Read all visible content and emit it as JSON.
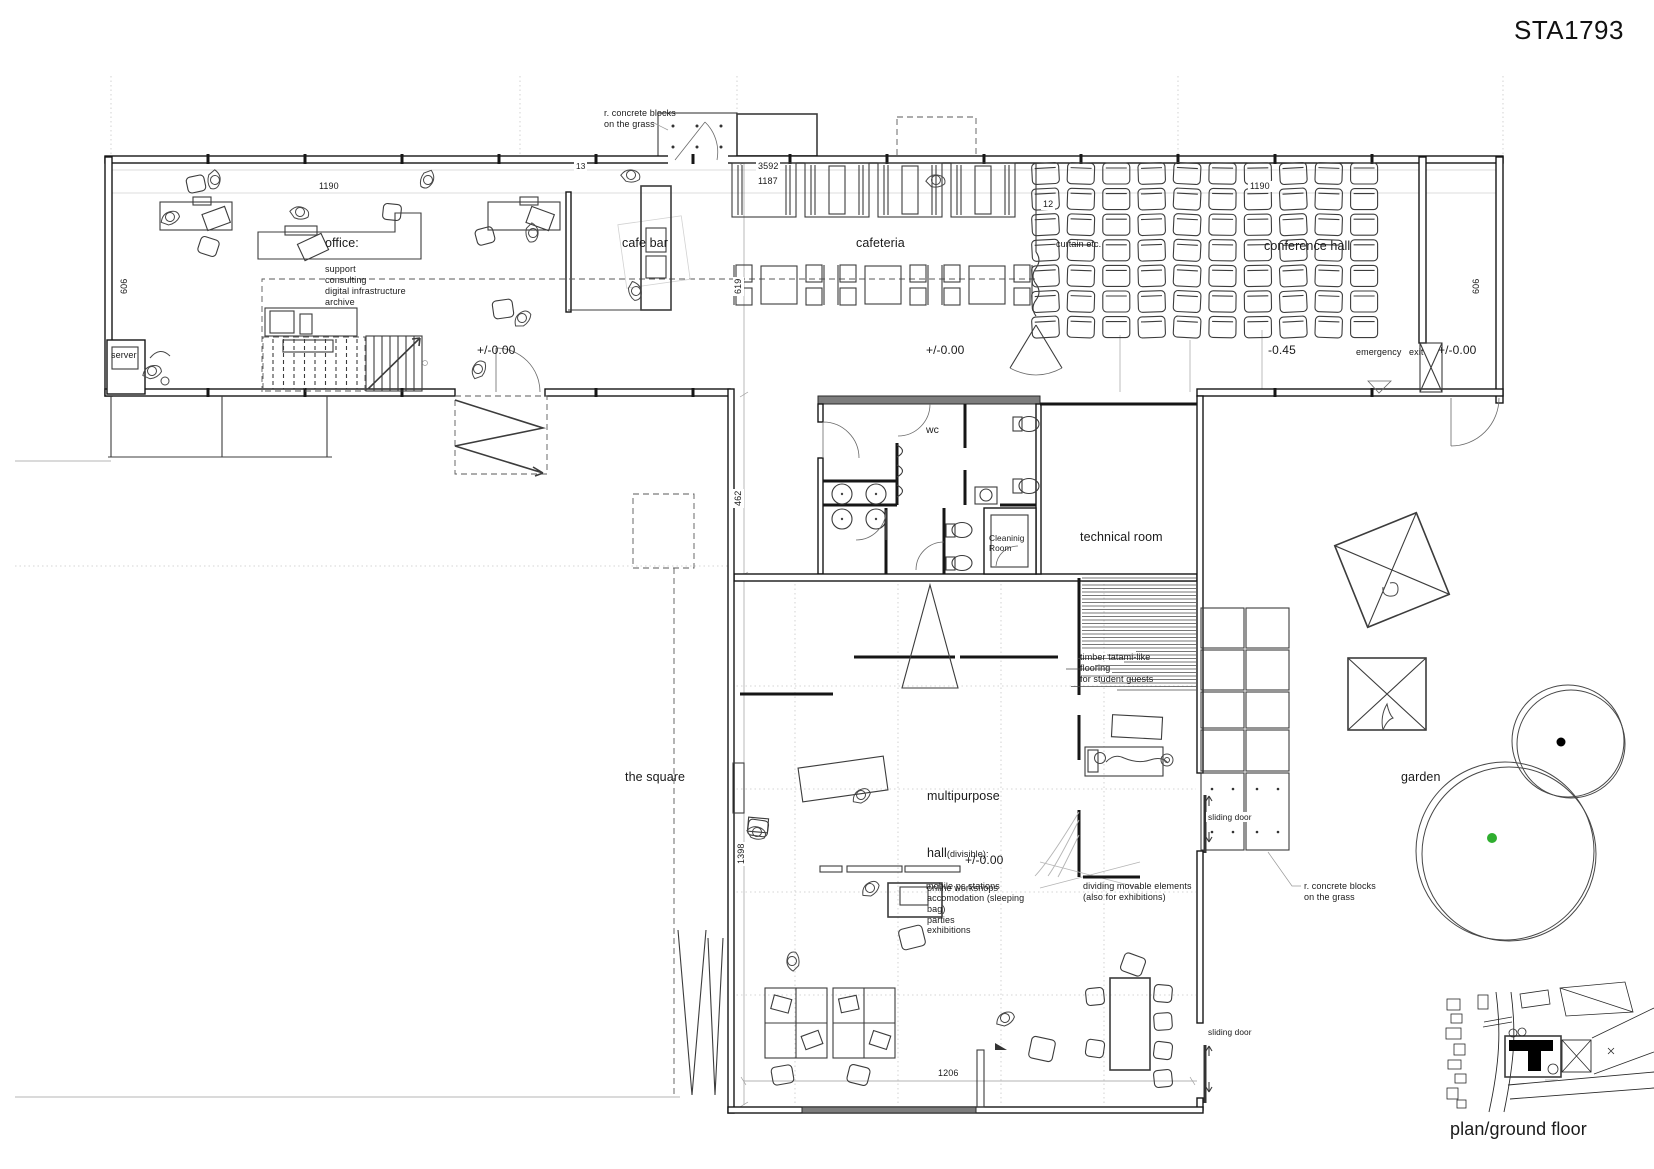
{
  "title": "STA1793",
  "caption": "plan/ground floor",
  "rooms": {
    "office": {
      "name": "office:",
      "functions": "support\nconsulting\ndigital infrastructure\narchive",
      "server": "server",
      "level": "+/-0.00"
    },
    "cafe_bar": {
      "name": "cafe bar"
    },
    "cafeteria": {
      "name": "cafeteria",
      "level": "+/-0.00"
    },
    "conference_hall": {
      "name": "conference hall",
      "level": "-0.45",
      "curtain": "curtain etc.",
      "emergency_exit": "emergency exit",
      "exit_level": "+/-0.00"
    },
    "wc": {
      "name": "wc",
      "cleaning_room": "Cleaninig\nRoom"
    },
    "technical_room": {
      "name": "technical room"
    },
    "multipurpose_hall": {
      "name_line1": "multipurpose",
      "name_line2": "hall",
      "divisible": "(divisible):",
      "uses": "online workshops\naccomodation (sleeping\nbag)\nparties\nexhibitions",
      "level": "+/-0.00",
      "tatami_note": "timber tatami-like\nflooring\nfor student guests",
      "pc_note": "mobile pc stations",
      "dividers_note": "dividing movable elements\n(also for exhibitions)",
      "sliding_door_upper": "sliding door",
      "sliding_door_lower": "sliding door"
    },
    "outdoor": {
      "square": "the square",
      "garden": "garden",
      "concrete_blocks_top": "r. concrete blocks\non the grass",
      "concrete_blocks_right": "r. concrete blocks\non the grass"
    }
  },
  "dimensions": {
    "office_width": "1190",
    "office_depth": "606",
    "entry_gap": "13",
    "cafeteria_width": "3592",
    "cafeteria_width2": "1187",
    "cafeteria_depth": "619",
    "conference_width": "1190",
    "conference_depth": "606",
    "conference_gap": "12",
    "wc_depth": "462",
    "hall_depth": "1398",
    "hall_width": "1206"
  },
  "colors": {
    "line": "#1c1c1c",
    "light_line": "#c9c9c9",
    "tree_dot_black": "#000000",
    "tree_dot_green": "#2fae2f",
    "site_building": "#000000"
  }
}
